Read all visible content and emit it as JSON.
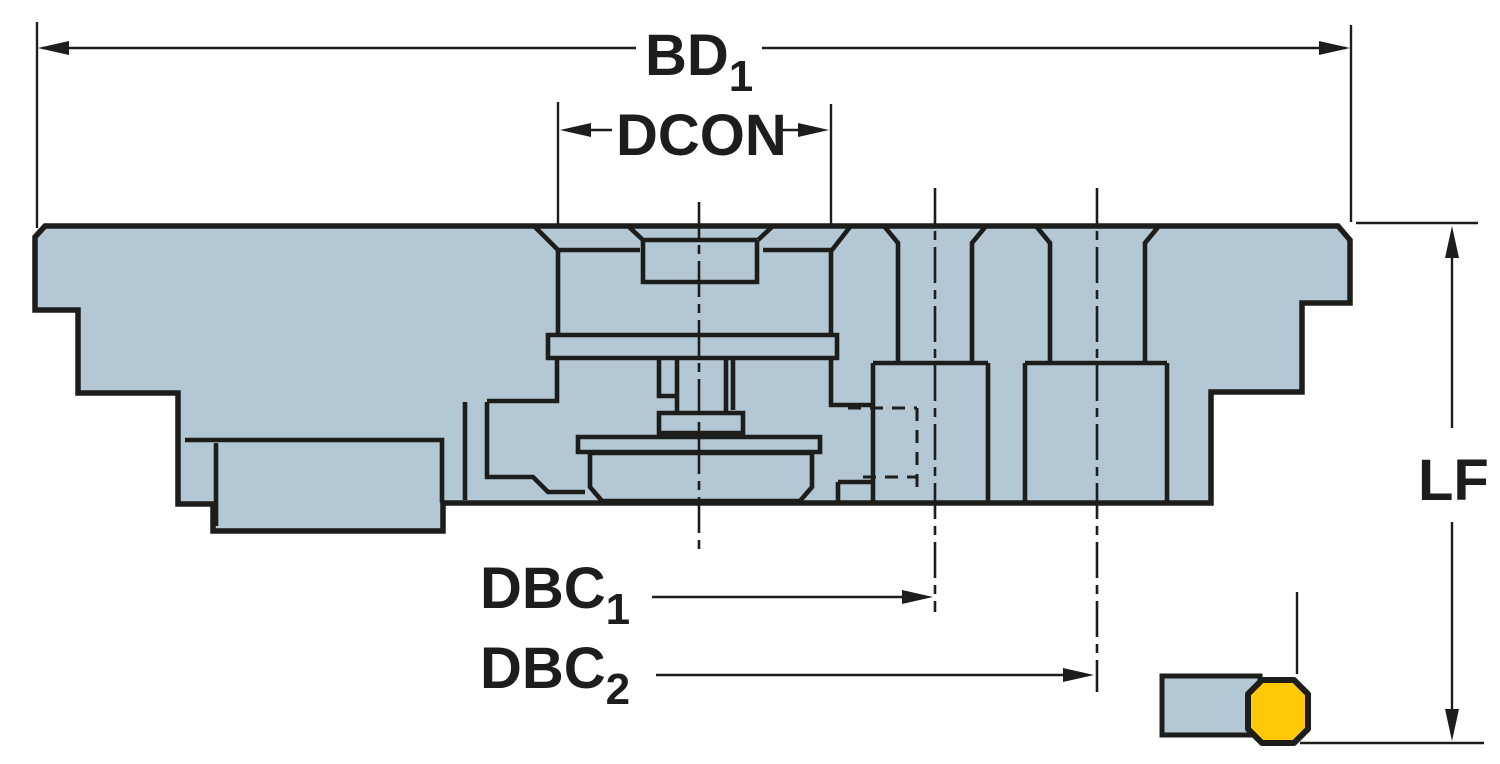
{
  "drawing": {
    "title": "Tool adapter cross-section dimensional drawing",
    "labels": {
      "bd1": {
        "main": "BD",
        "sub": "1"
      },
      "dcon": {
        "main": "DCON",
        "sub": ""
      },
      "dbc1": {
        "main": "DBC",
        "sub": "1"
      },
      "dbc2": {
        "main": "DBC",
        "sub": "2"
      },
      "lf": {
        "main": "LF",
        "sub": ""
      }
    },
    "colors": {
      "body_fill": "#b3c8d4",
      "insert_fill": "#ffc907",
      "line": "#1d1d1b",
      "background": "#ffffff"
    }
  }
}
